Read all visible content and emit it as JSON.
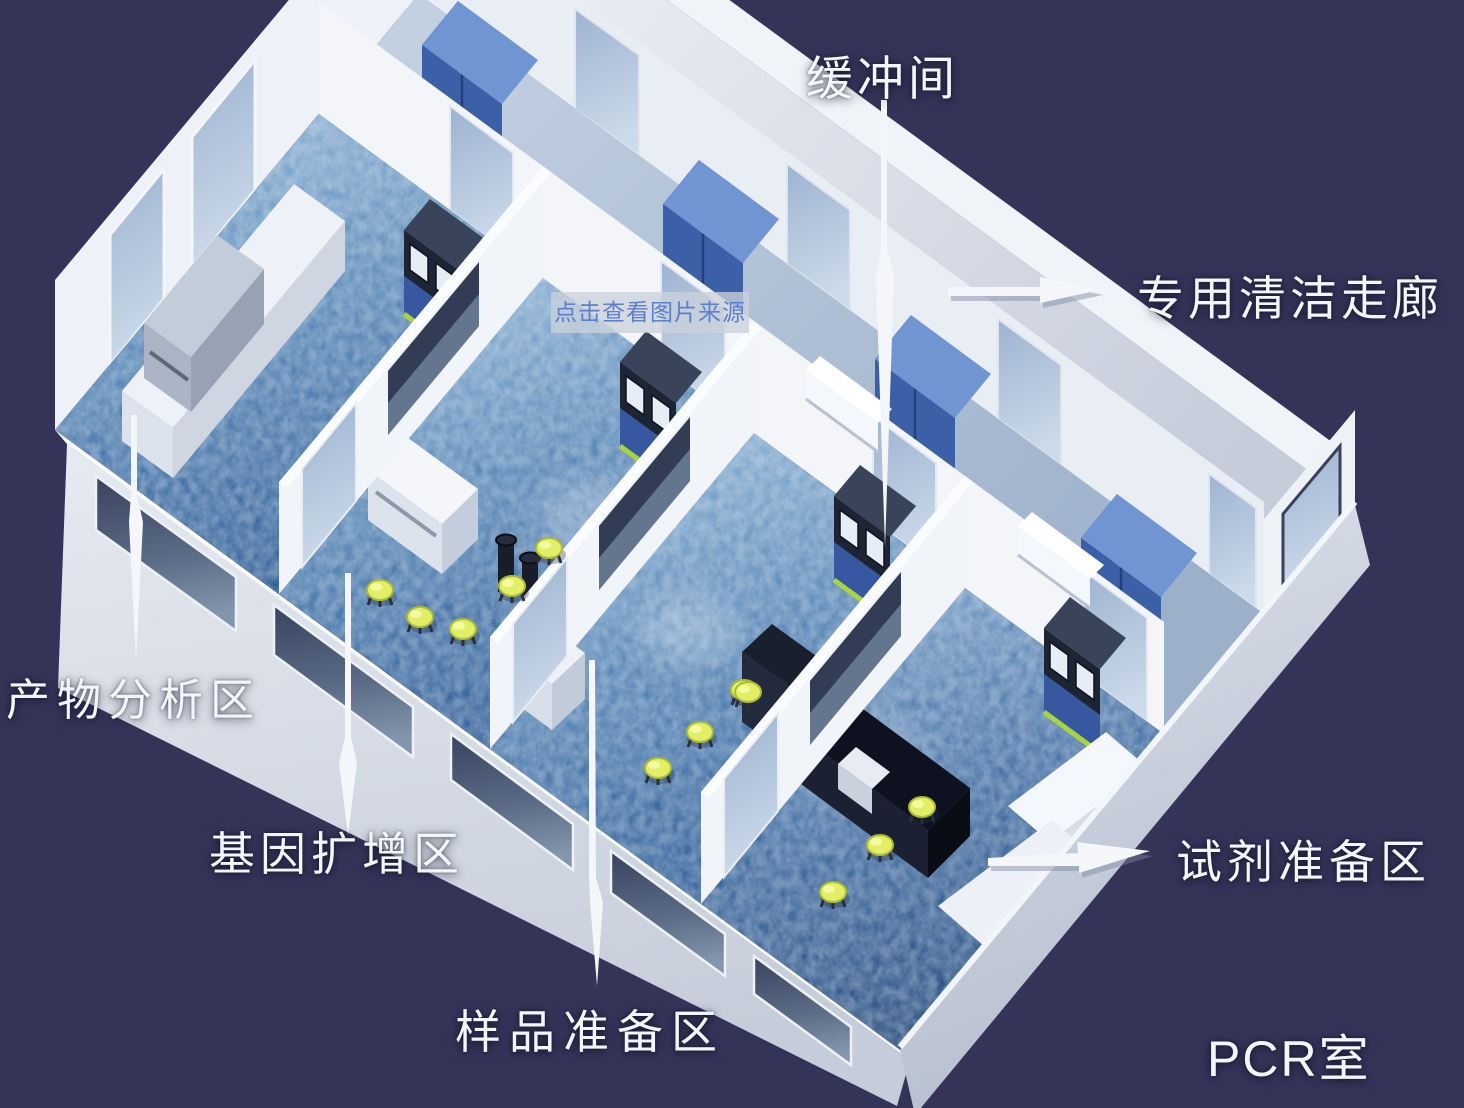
{
  "labels": {
    "buffer_room": "缓冲间",
    "clean_corridor": "专用清洁走廊",
    "product_analysis": "产物分析区",
    "gene_amplification": "基因扩增区",
    "sample_preparation": "样品准备区",
    "reagent_preparation": "试剂准备区",
    "pcr_room": "PCR室"
  },
  "watermark": {
    "text": "点击查看图片来源"
  },
  "colors": {
    "background": "#353358",
    "wall_white": "#f1f4f8",
    "corridor_gray": "#d8dde8",
    "floor_light": "#93b7da",
    "floor_dark": "#2e5d97",
    "cabinet_blue": "#3c60a8",
    "glass_blue": "#b7cade",
    "stool_yellow": "#e2ef66",
    "label_white": "#f4f5f9",
    "watermark_text": "#5c7fce"
  }
}
